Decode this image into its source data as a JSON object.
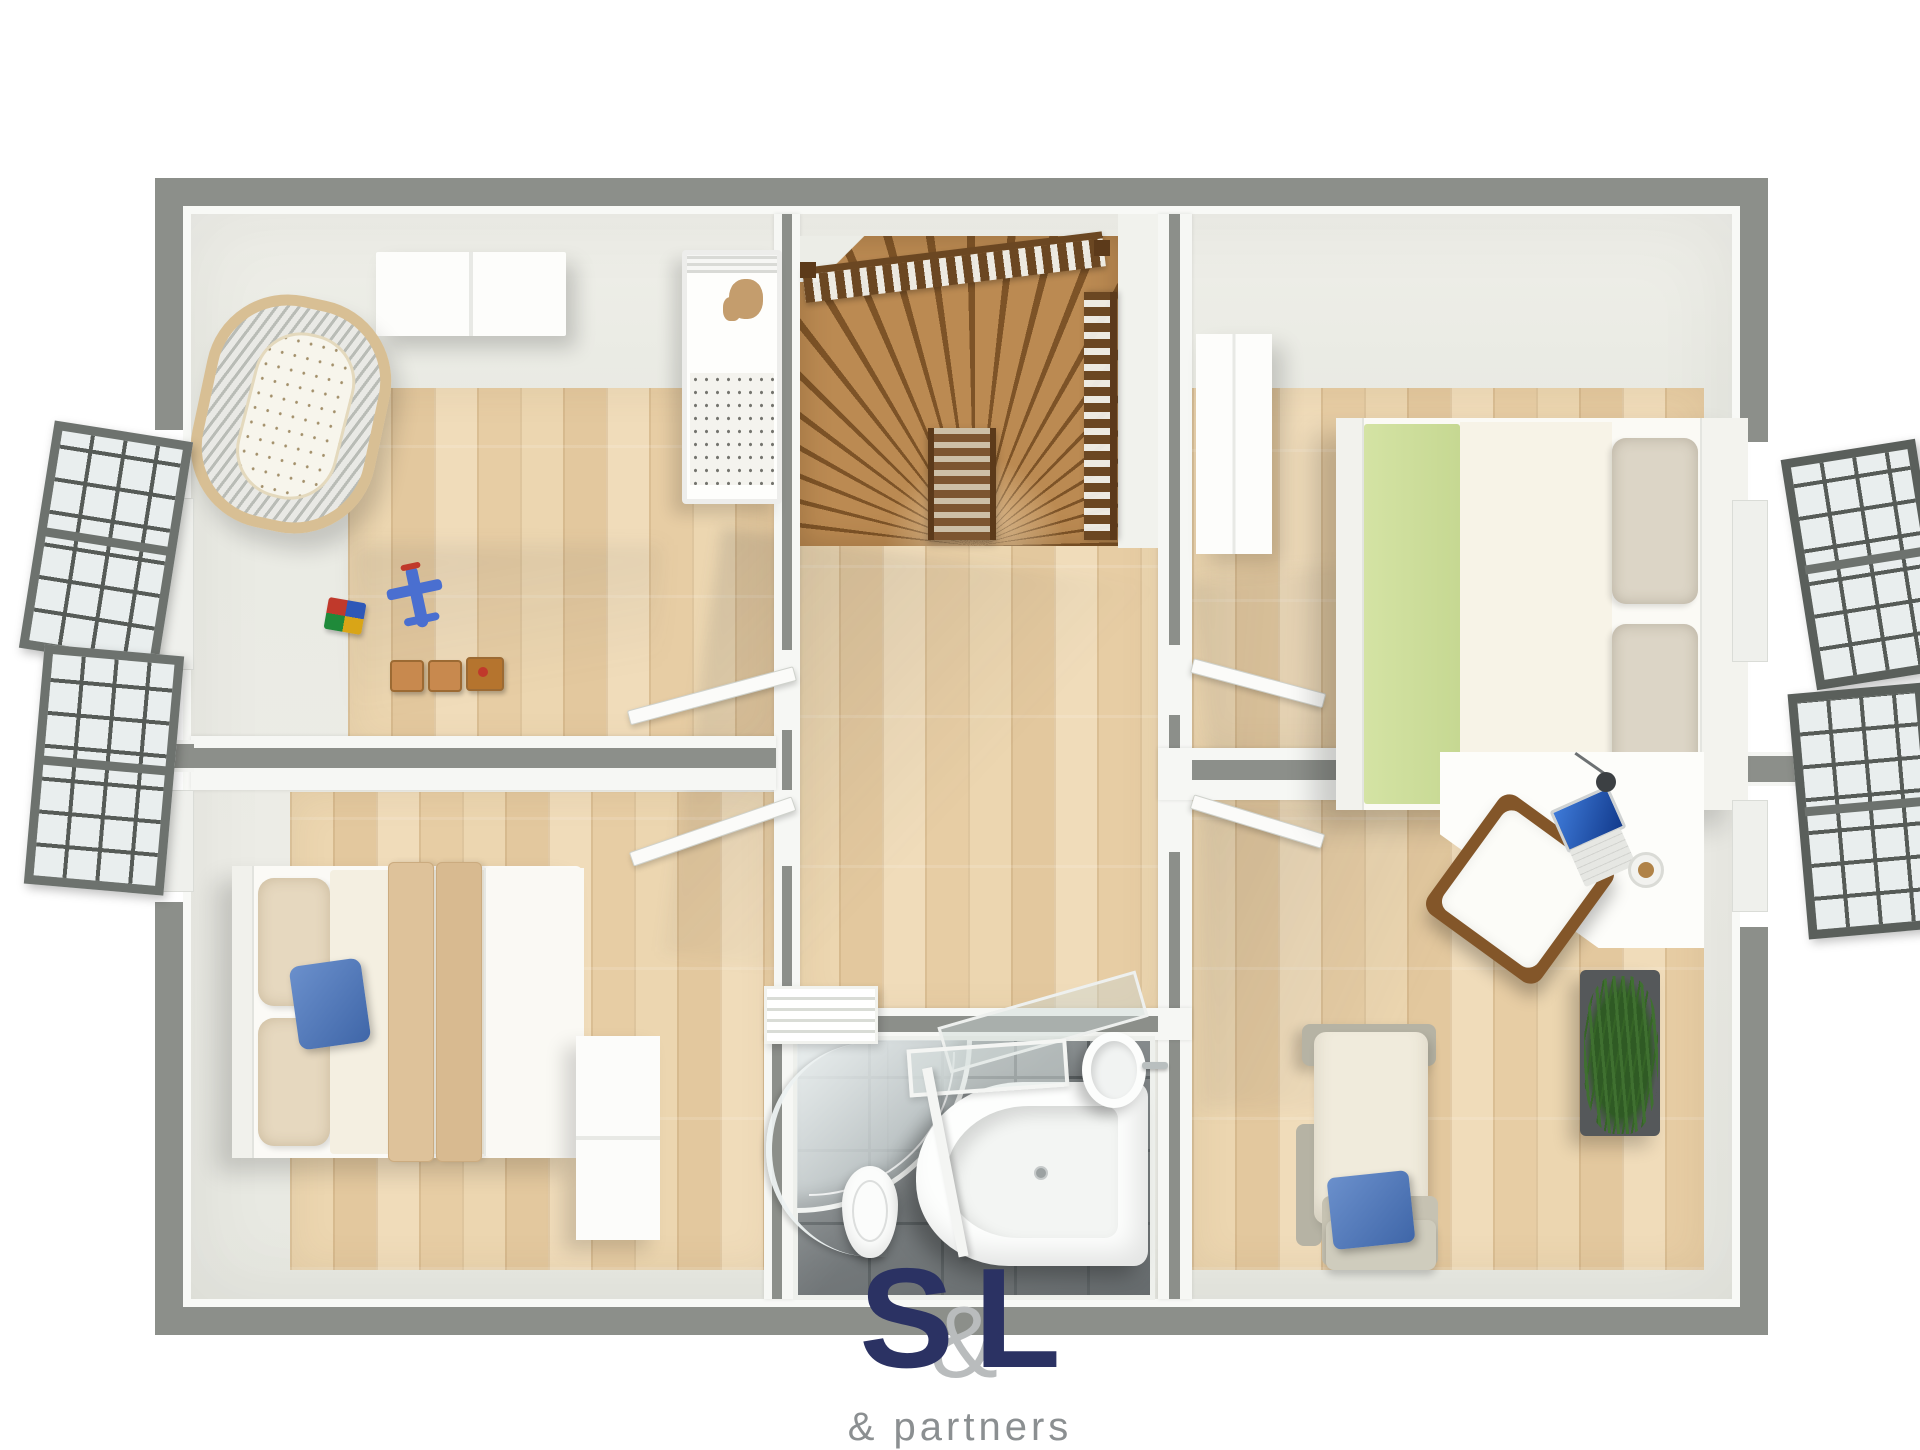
{
  "brand": {
    "letter_s": "S",
    "ampersand": "&",
    "letter_l": "L",
    "tagline": "& partners",
    "navy": "#2b3263",
    "amp_gray": "#b9bcbd",
    "tagline_gray": "#8b8f91"
  },
  "palette": {
    "exterior_wall": "#8c8f8a",
    "interior_wall": "#eaebe5",
    "trim": "#f8f9f6",
    "wood_floor": "#e8d1aa",
    "stair_wood": "#bb8a52",
    "balustrade": "#6b4722",
    "bathroom_tile": "#74797b",
    "accent_green_throw": "#cde09b",
    "accent_blue_pillow": "#4f79bd",
    "plant_green": "#3f7030"
  },
  "floorplan": {
    "rooms": [
      {
        "name": "nursery",
        "furniture": [
          "dresser",
          "baby-cot",
          "teddy-bear",
          "oval-crib",
          "toy-blocks",
          "toy-airplane",
          "toy-train"
        ]
      },
      {
        "name": "bedroom-bottom-left",
        "furniture": [
          "double-bed",
          "pillows",
          "blue-pillow",
          "dresser"
        ]
      },
      {
        "name": "bedroom-top-right",
        "furniture": [
          "wardrobe",
          "double-bed",
          "green-throw",
          "pillows"
        ]
      },
      {
        "name": "home-office",
        "furniture": [
          "corner-desk",
          "laptop",
          "desk-lamp",
          "coffee-cup",
          "wooden-chair",
          "planter",
          "armchair",
          "blue-pillow"
        ]
      },
      {
        "name": "bathroom",
        "furniture": [
          "corner-shower",
          "toilet",
          "corner-bathtub",
          "sink",
          "glass-screen",
          "radiator"
        ]
      },
      {
        "name": "landing",
        "furniture": [
          "winder-staircase",
          "balustrade",
          "doors"
        ]
      }
    ],
    "windows": {
      "left": 2,
      "right": 2
    }
  }
}
